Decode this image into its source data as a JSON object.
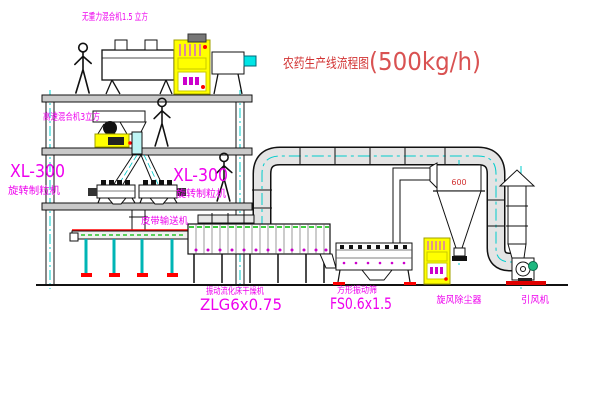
{
  "title": {
    "name": "农药生产线流程图",
    "capacity": "(500kg/h)"
  },
  "labels": {
    "top_mixer": "无重力混合机1.5 立方",
    "mid_mixer": "高速混合机3立方",
    "granulator_left_model": "XL-300",
    "granulator_left_name": "旋转制粒机",
    "granulator_right_model": "XL-300",
    "granulator_right_name": "旋转制粒机",
    "belt_conveyor": "皮带输送机",
    "dryer_name": "振动流化床干燥机",
    "dryer_model": "ZLG6x0.75",
    "sieve_name": "方形振动筛",
    "sieve_model": "FS0.6x1.5",
    "cyclone_name": "旋风除尘器",
    "cyclone_size": "600",
    "fan_name": "引风机"
  },
  "colors": {
    "label_magenta": "#ee00ee",
    "title_red": "#d23434",
    "line_black": "#111111",
    "centerline_cyan": "#00cccc",
    "cabinet_yellow": "#ffff00",
    "detail_green": "#00bb00",
    "accent_red": "#ff0000",
    "duct_gray": "#e4e4e4"
  }
}
